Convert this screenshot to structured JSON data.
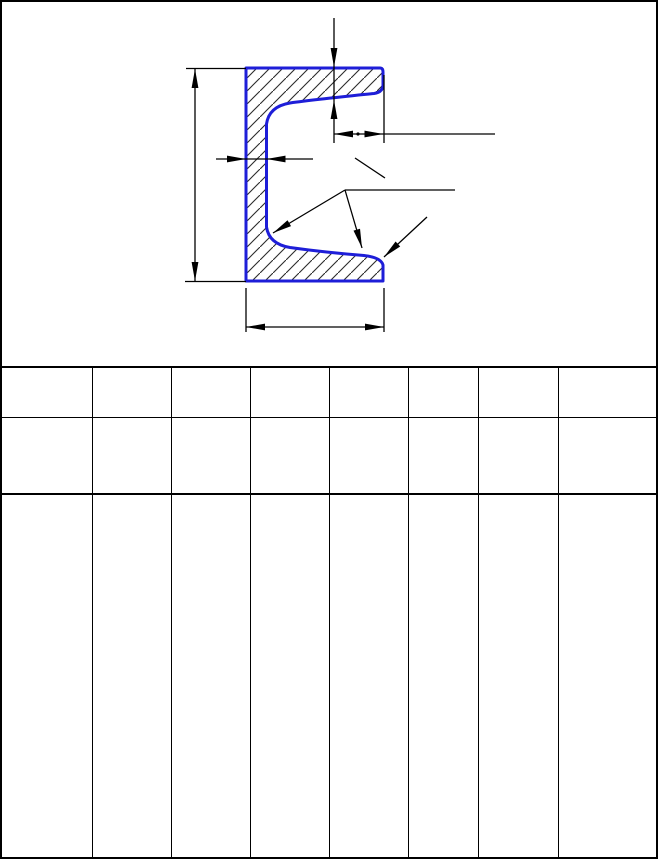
{
  "document": {
    "kind": "engineering drawing sheet with empty specification table",
    "background": "#ffffff",
    "border_color": "#000000"
  },
  "colors": {
    "profile_stroke": "#1e1ed8",
    "hatch_line": "#2b2b2b",
    "dimension_line": "#000000",
    "table_line": "#000000"
  },
  "drawing": {
    "shape": "channel-section-cross-section",
    "hatch": {
      "angle_deg": 45,
      "spacing_px": 13
    },
    "annotations": [
      {
        "name": "height-dimension",
        "orientation": "vertical",
        "side": "left"
      },
      {
        "name": "flange-width-dimension",
        "orientation": "horizontal",
        "side": "bottom"
      },
      {
        "name": "web-thickness-dimension",
        "orientation": "horizontal",
        "side": "middle-left"
      },
      {
        "name": "flange-thickness-dimension",
        "orientation": "vertical",
        "side": "top"
      },
      {
        "name": "flange-tip-dimension",
        "orientation": "horizontal",
        "side": "top-right"
      },
      {
        "name": "fillet-radius-leader"
      },
      {
        "name": "flange-slope-leader"
      },
      {
        "name": "tip-radius-leader"
      }
    ]
  },
  "table": {
    "columns": 8,
    "rows": 3,
    "column_widths_px": [
      93,
      79,
      79,
      79,
      79,
      70,
      80,
      97
    ],
    "row_heights_px": [
      52,
      79,
      360
    ],
    "cells": [
      [
        "",
        "",
        "",
        "",
        "",
        "",
        "",
        ""
      ],
      [
        "",
        "",
        "",
        "",
        "",
        "",
        "",
        ""
      ],
      [
        "",
        "",
        "",
        "",
        "",
        "",
        "",
        ""
      ]
    ]
  }
}
